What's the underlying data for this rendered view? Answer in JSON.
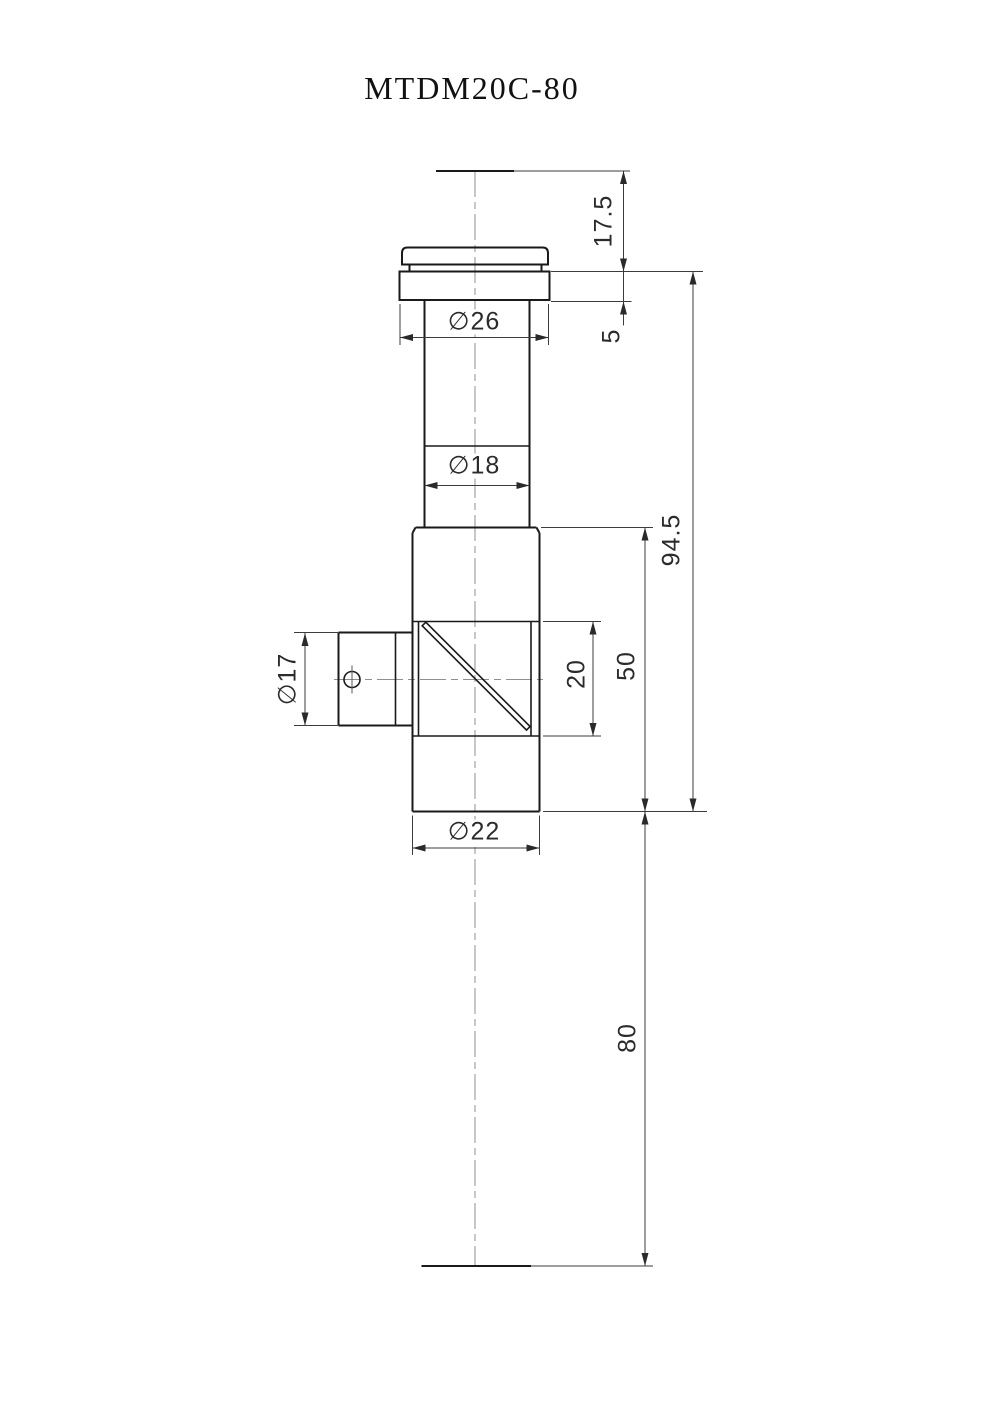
{
  "title": "MTDM20C-80",
  "colors": {
    "background": "#ffffff",
    "object_line": "#1a1a1a",
    "dimension_line": "#3c3c3c",
    "center_line": "#8f8f8f"
  },
  "dimensions": {
    "cap_height": "17.5",
    "flange_thickness": "5",
    "flange_diameter": "∅26",
    "tube_diameter": "∅18",
    "side_port_diameter": "∅17",
    "prism_window_height": "20",
    "body_section_length": "50",
    "upper_section_length": "94.5",
    "lower_extension_length": "80",
    "body_diameter": "∅22"
  }
}
